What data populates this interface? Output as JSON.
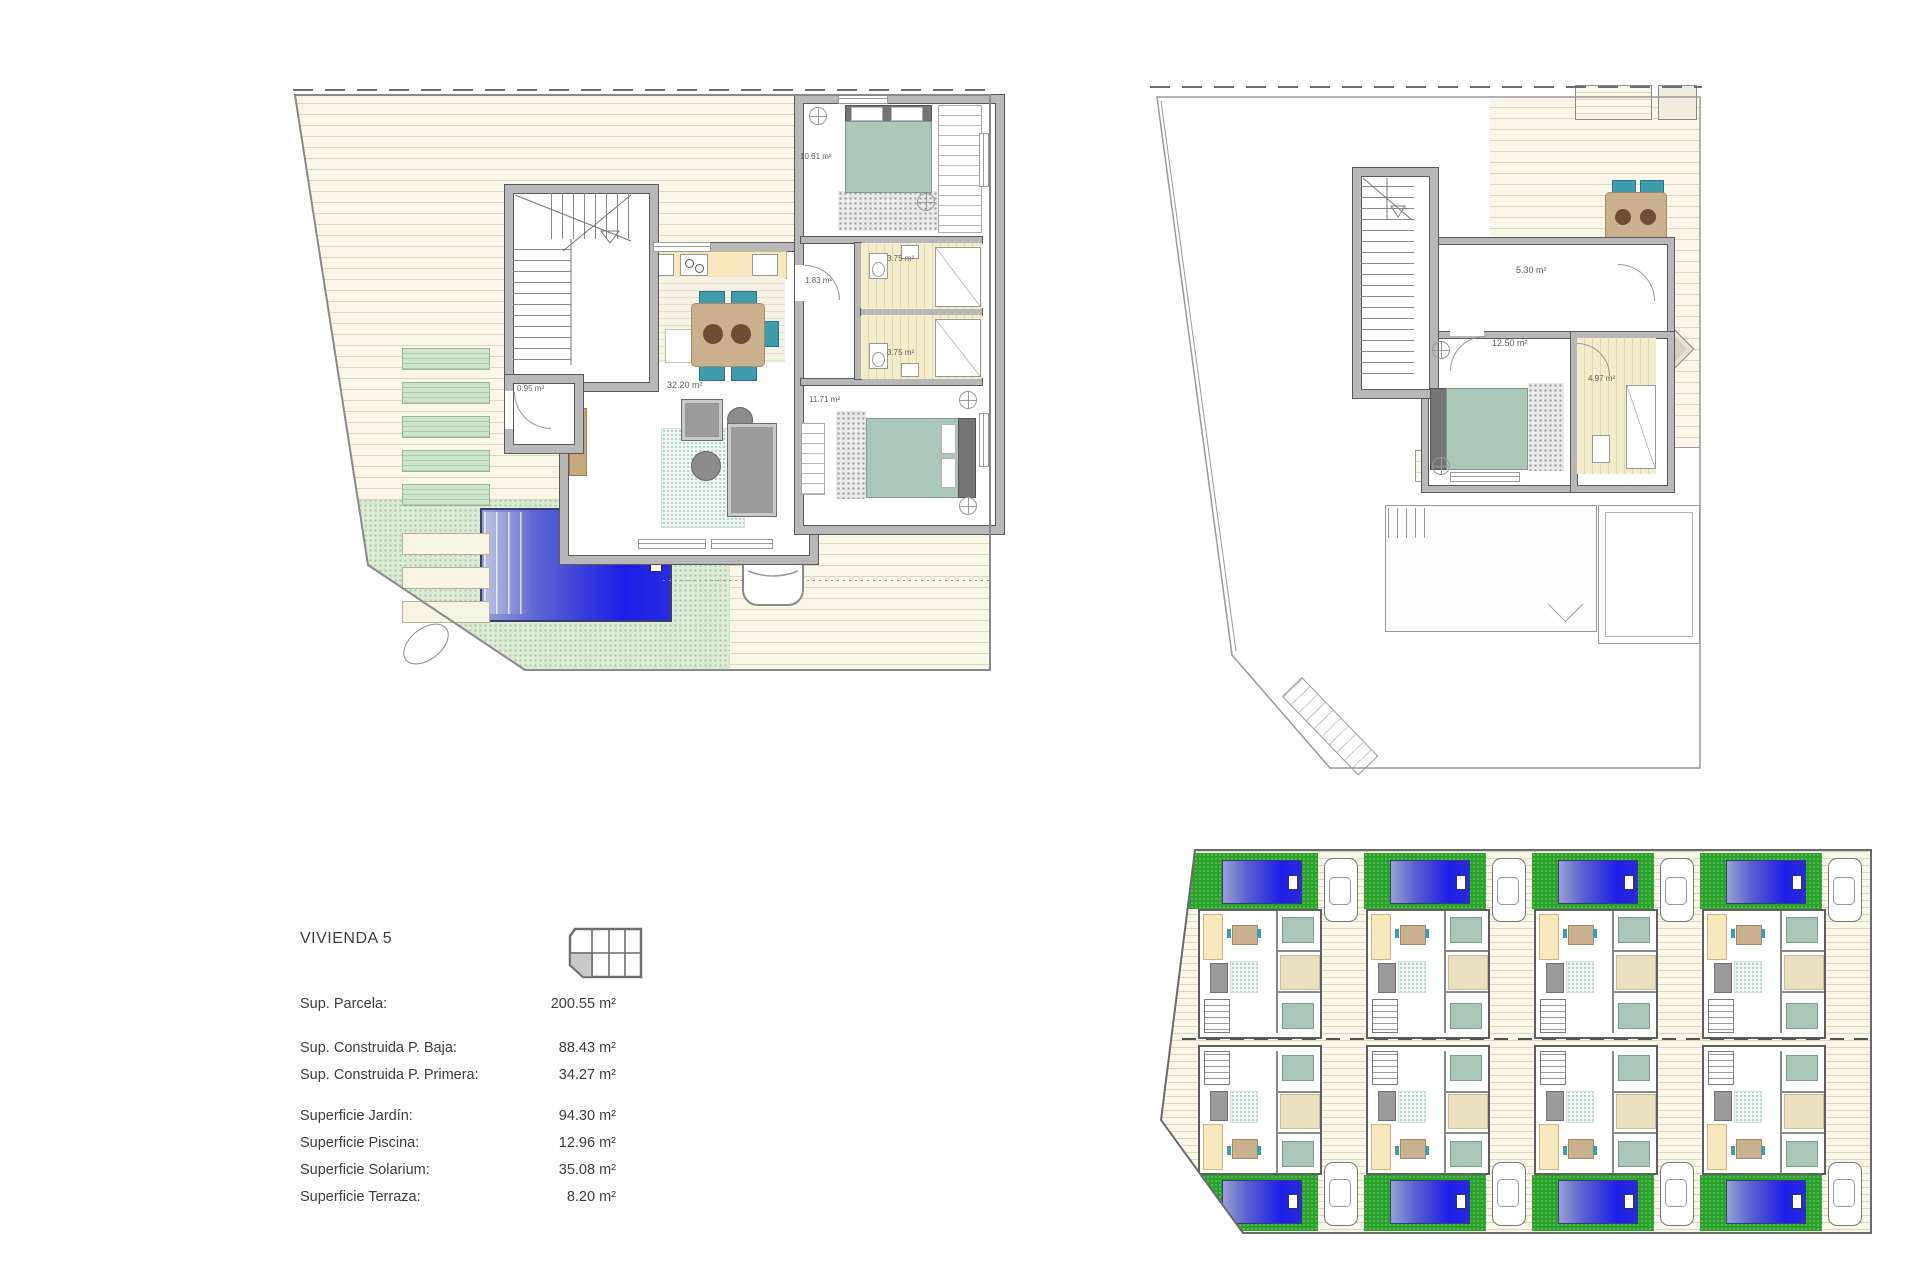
{
  "info": {
    "title": "VIVIENDA 5",
    "groups": [
      [
        {
          "label": "Sup. Parcela:",
          "value": "200.55 m²"
        }
      ],
      [
        {
          "label": "Sup. Construida P. Baja:",
          "value": "88.43 m²"
        },
        {
          "label": "Sup. Construida P. Primera:",
          "value": "34.27 m²"
        }
      ],
      [
        {
          "label": "Superficie Jardín:",
          "value": "94.30 m²"
        },
        {
          "label": "Superficie Piscina:",
          "value": "12.96 m²"
        },
        {
          "label": "Superficie Solarium:",
          "value": "35.08 m²"
        },
        {
          "label": "Superficie Terraza:",
          "value": "8.20 m²"
        }
      ]
    ]
  },
  "ground_floor": {
    "labels": {
      "living": "32.20 m²",
      "entry": "0.95 m²",
      "bedroom1": "10.61 m²",
      "hall": "1.83 m²",
      "bath1": "3.75 m²",
      "bath2": "3.75 m²",
      "bedroom2": "11.71 m²"
    },
    "tv": "TV"
  },
  "first_floor": {
    "labels": {
      "landing": "5.30 m²",
      "bedroom": "12.50 m²",
      "bath": "4.97 m²"
    }
  },
  "colors": {
    "wall": "#b8b8b8",
    "wall-edge": "#5a5a5a",
    "deck-base": "#faf7ea",
    "deck-line": "#ddd8bd",
    "garden-pale": "#dcead6",
    "garden-dot": "#a6c9a0",
    "site-green": "#2aa32a",
    "pool-deep": "#1d1de8",
    "pool-light": "#97a0d6",
    "counter": "#f8e9bd",
    "table-tan": "#c9b08e",
    "chair-teal": "#3f9dab",
    "bed-green": "#abc7b8",
    "sofa-gray": "#9b9b9b",
    "bath-base": "#f3edcd",
    "bath-line": "#e0d8ad",
    "label": "#5f5f5f",
    "text": "#3d3d3d",
    "line": "#8a8a8a"
  }
}
